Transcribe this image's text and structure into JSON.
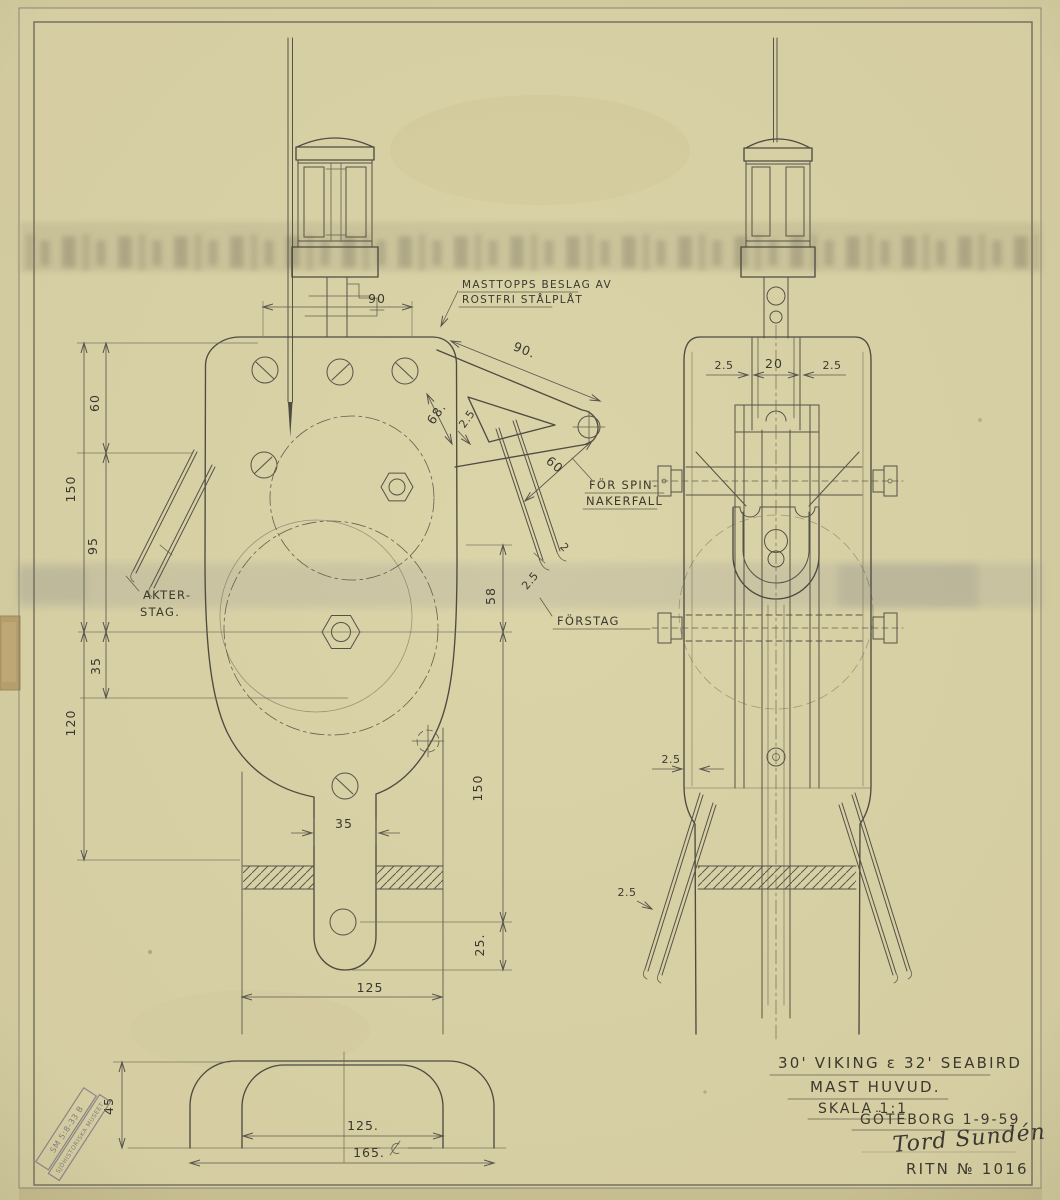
{
  "annotations": {
    "masthead_note_line1": "MASTTOPPS BESLAG AV",
    "masthead_note_line2": "ROSTFRI STÅLPLÅT",
    "spinnaker_note_line1": "FÖR SPIN-",
    "spinnaker_note_line2": "NAKERFALL",
    "akterstag_label_line1": "AKTER-",
    "akterstag_label_line2": "STAG.",
    "forstag_label": "FÖRSTAG"
  },
  "dimensions": {
    "head_width": "90",
    "crane_length": "90.",
    "crane_offset": "68.",
    "crane_plate_thickness": "2.5",
    "crane_drop": "60",
    "left_upper": "60",
    "left_overall_upper": "150",
    "left_mid": "95",
    "left_small": "35",
    "left_overall_lower": "120",
    "sheave_center": "58",
    "strap_width": "35",
    "strap_length": "150",
    "strap_end": "25.",
    "mast_width": "125",
    "forestay_wire": "2",
    "forestay_gap": "2.5",
    "side_flange_left": "2.5",
    "side_slot": "20",
    "side_flange_right": "2.5",
    "side_wall": "2.5",
    "side_stay": "2.5",
    "plan_height": "45",
    "plan_inner_width": "125.",
    "plan_outer_width": "165."
  },
  "title_block": {
    "boats": "30' VIKING ε 32' SEABIRD",
    "drawing_title": "MAST HUVUD.",
    "scale": "SKALA 1:1",
    "place_date": "GÖTEBORG 1-9-59",
    "signature": "Tord Sundén",
    "drawing_number": "RITN № 1016"
  },
  "stamp": {
    "line1": "SM 5:8-33 B",
    "line2": "SJÖHISTORISKA MUSEET"
  },
  "colors": {
    "paper": "#d9d2a6",
    "line": "#4e4b41",
    "pencil_text": "#3b392f",
    "stamp_ink": "#6f6878"
  }
}
